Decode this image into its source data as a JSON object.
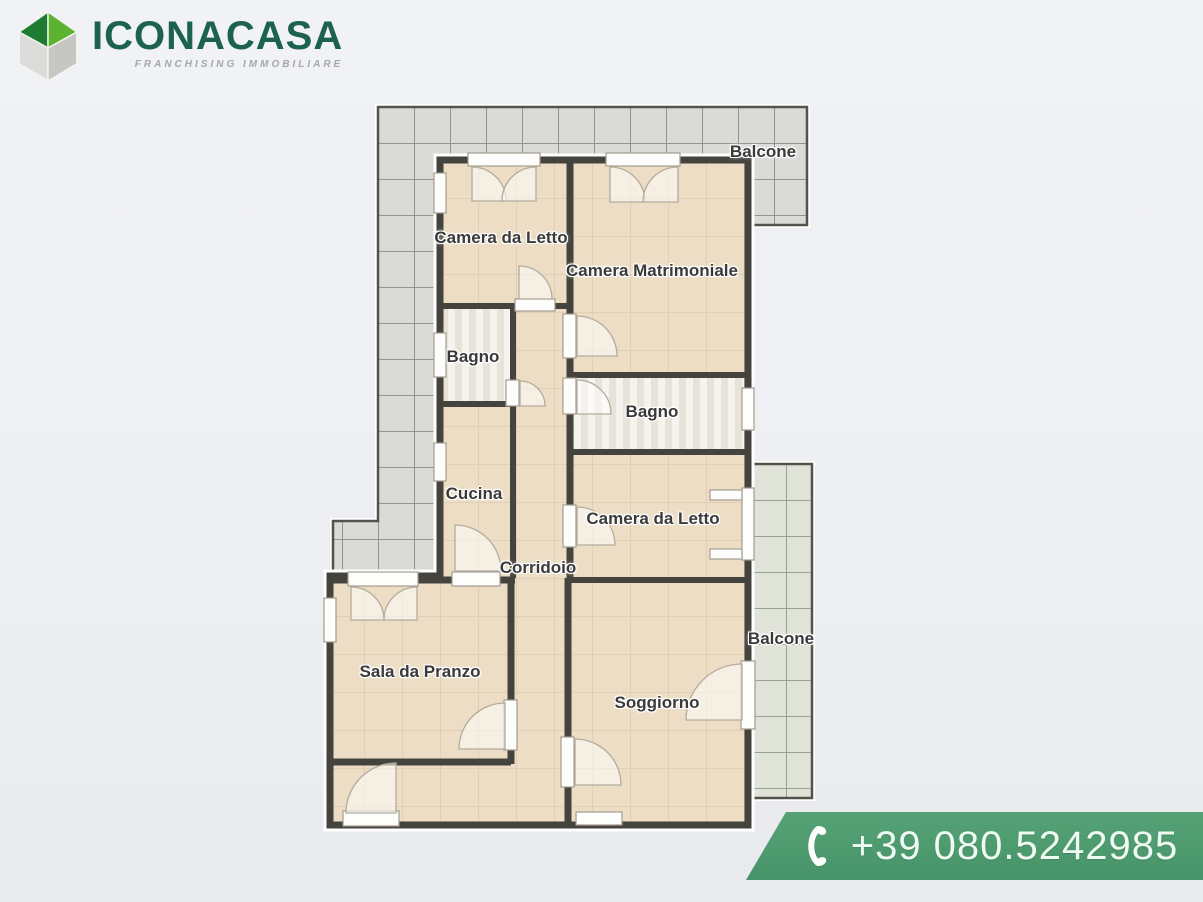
{
  "branding": {
    "logo_text": "ICONACASA",
    "logo_tagline": "FRANCHISING IMMOBILIARE",
    "logo_color": "#1d6150",
    "tagline_color": "#a6a7af",
    "cube_green_dark": "#1e7c30",
    "cube_green_light": "#5cb32f",
    "cube_gray_light": "#dcdcda",
    "cube_gray_dark": "#c6c6c3"
  },
  "contact": {
    "phone": "+39 080.5242985",
    "banner_color": "#4f9c70",
    "text_color": "#eefaf2",
    "icon": "phone-handset-icon"
  },
  "floorplan": {
    "rooms": [
      {
        "id": "balcone-top",
        "label": "Balcone"
      },
      {
        "id": "camera-da-letto-1",
        "label": "Camera da Letto"
      },
      {
        "id": "camera-matrimoniale",
        "label": "Camera Matrimoniale"
      },
      {
        "id": "bagno-1",
        "label": "Bagno"
      },
      {
        "id": "bagno-2",
        "label": "Bagno"
      },
      {
        "id": "cucina",
        "label": "Cucina"
      },
      {
        "id": "camera-da-letto-2",
        "label": "Camera da Letto"
      },
      {
        "id": "corridoio",
        "label": "Corridoio"
      },
      {
        "id": "sala-da-pranzo",
        "label": "Sala da Pranzo"
      },
      {
        "id": "soggiorno",
        "label": "Soggiorno"
      },
      {
        "id": "balcone-right",
        "label": "Balcone"
      }
    ],
    "colors": {
      "wall": "#45433e",
      "room_floor": "#ecddc4",
      "balcony_tile_gray": "#dadad7",
      "balcony_tile_green": "#e0e3d8",
      "bathroom_floor": "#f5f3ee",
      "label_text": "#3a3a3a"
    }
  }
}
